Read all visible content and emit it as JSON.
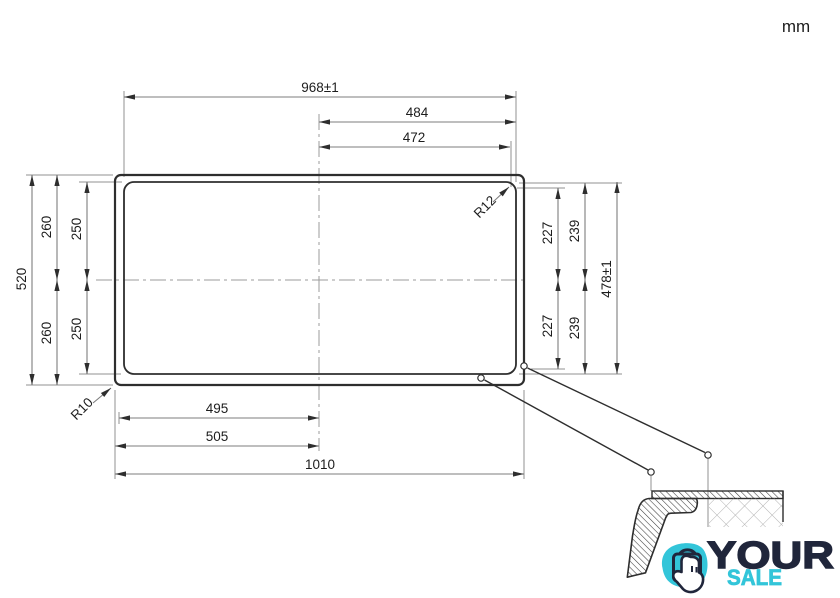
{
  "units_label": "mm",
  "drawing": {
    "type": "technical-dimension-drawing",
    "dims": {
      "top_overall": "968±1",
      "top_half_outer": "484",
      "top_half_inner": "472",
      "left_overall": "520",
      "left_top_outer": "260",
      "left_top_inner": "250",
      "left_bottom_outer": "260",
      "left_bottom_inner": "250",
      "right_top_inner": "227",
      "right_top_outer": "239",
      "right_bottom_inner": "227",
      "right_bottom_outer": "239",
      "right_overall": "478±1",
      "bottom_half_inner": "495",
      "bottom_half_outer": "505",
      "bottom_overall": "1010",
      "radius_inner_corner": "R12",
      "radius_outer_corner": "R10"
    }
  },
  "logo": {
    "word_top": "YOUR",
    "word_bottom": "SALE",
    "navy": "#20263B",
    "teal": "#33C5D9"
  },
  "colors": {
    "outline": "#2e2e2e",
    "dimension_line": "#7d7d7d",
    "text": "#1d1d1d"
  }
}
